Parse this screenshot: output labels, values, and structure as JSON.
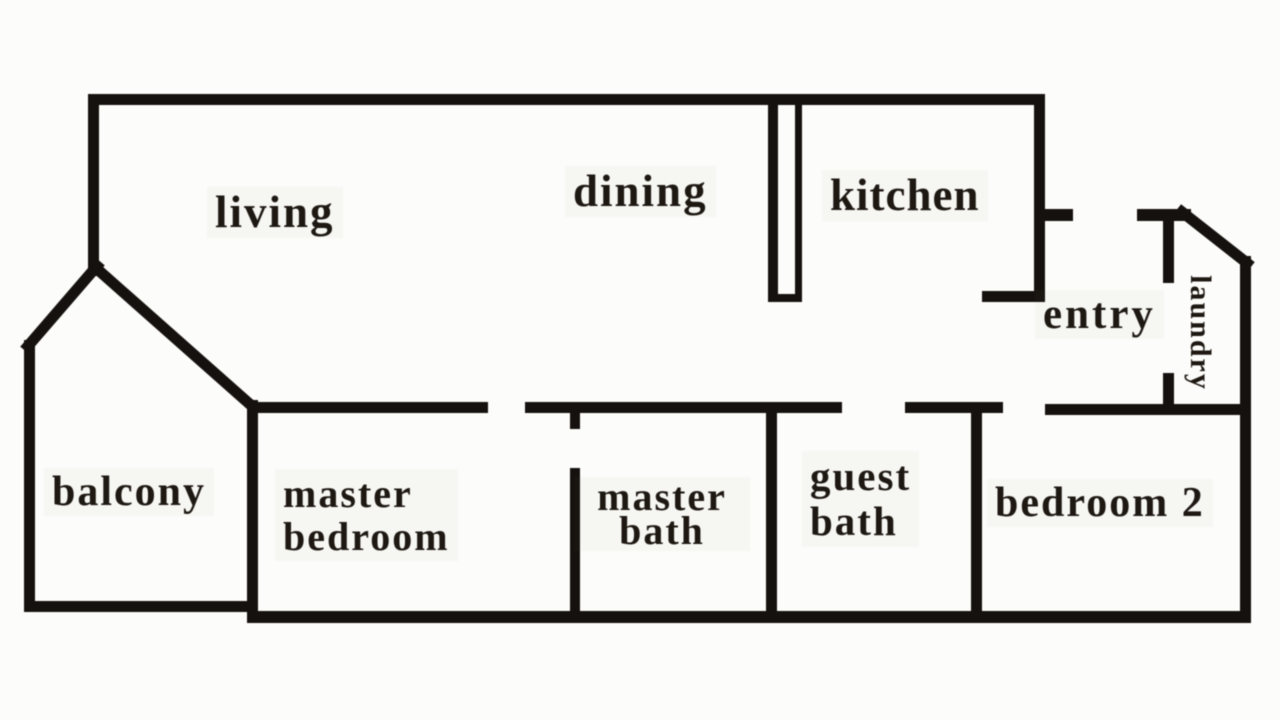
{
  "title": "apartment floor plan",
  "colors": {
    "background": "#fcfcfa",
    "wall": "#171310",
    "text": "#201a14"
  },
  "rooms": {
    "living": {
      "label": "living"
    },
    "dining": {
      "label": "dining"
    },
    "kitchen": {
      "label": "kitchen"
    },
    "entry": {
      "label": "entry"
    },
    "laundry": {
      "label": "laundry"
    },
    "balcony": {
      "label": "balcony"
    },
    "master_bedroom": {
      "line1": "master",
      "line2": "bedroom"
    },
    "master_bath": {
      "line1": "master",
      "line2": "bath"
    },
    "guest_bath": {
      "line1": "guest",
      "line2": "bath"
    },
    "bedroom_2": {
      "label": "bedroom 2"
    }
  }
}
